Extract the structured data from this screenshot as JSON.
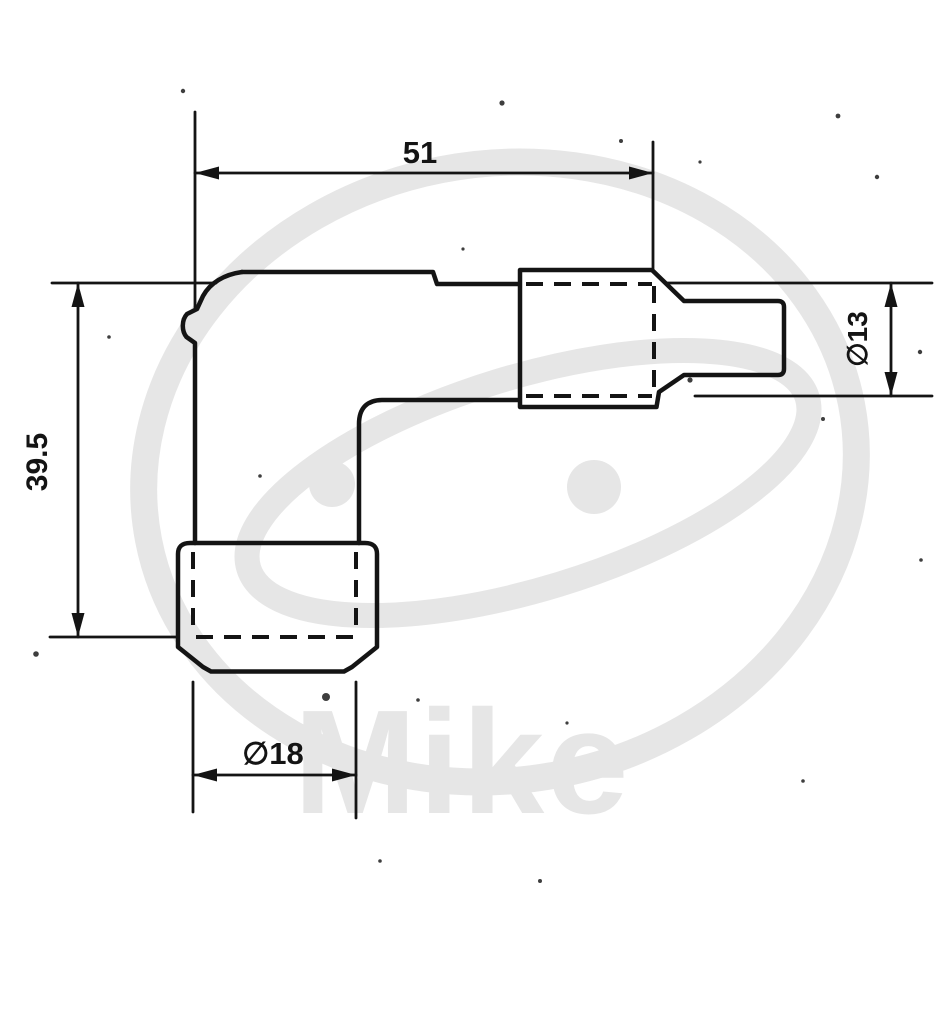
{
  "dimensions": {
    "width": "51",
    "height": "39.5",
    "tip_diameter": "∅13",
    "base_diameter": "∅18"
  },
  "watermark": {
    "text": "Mike"
  },
  "colors": {
    "ink": "#141414",
    "watermark": "#e6e6e6",
    "paper": "#ffffff"
  }
}
